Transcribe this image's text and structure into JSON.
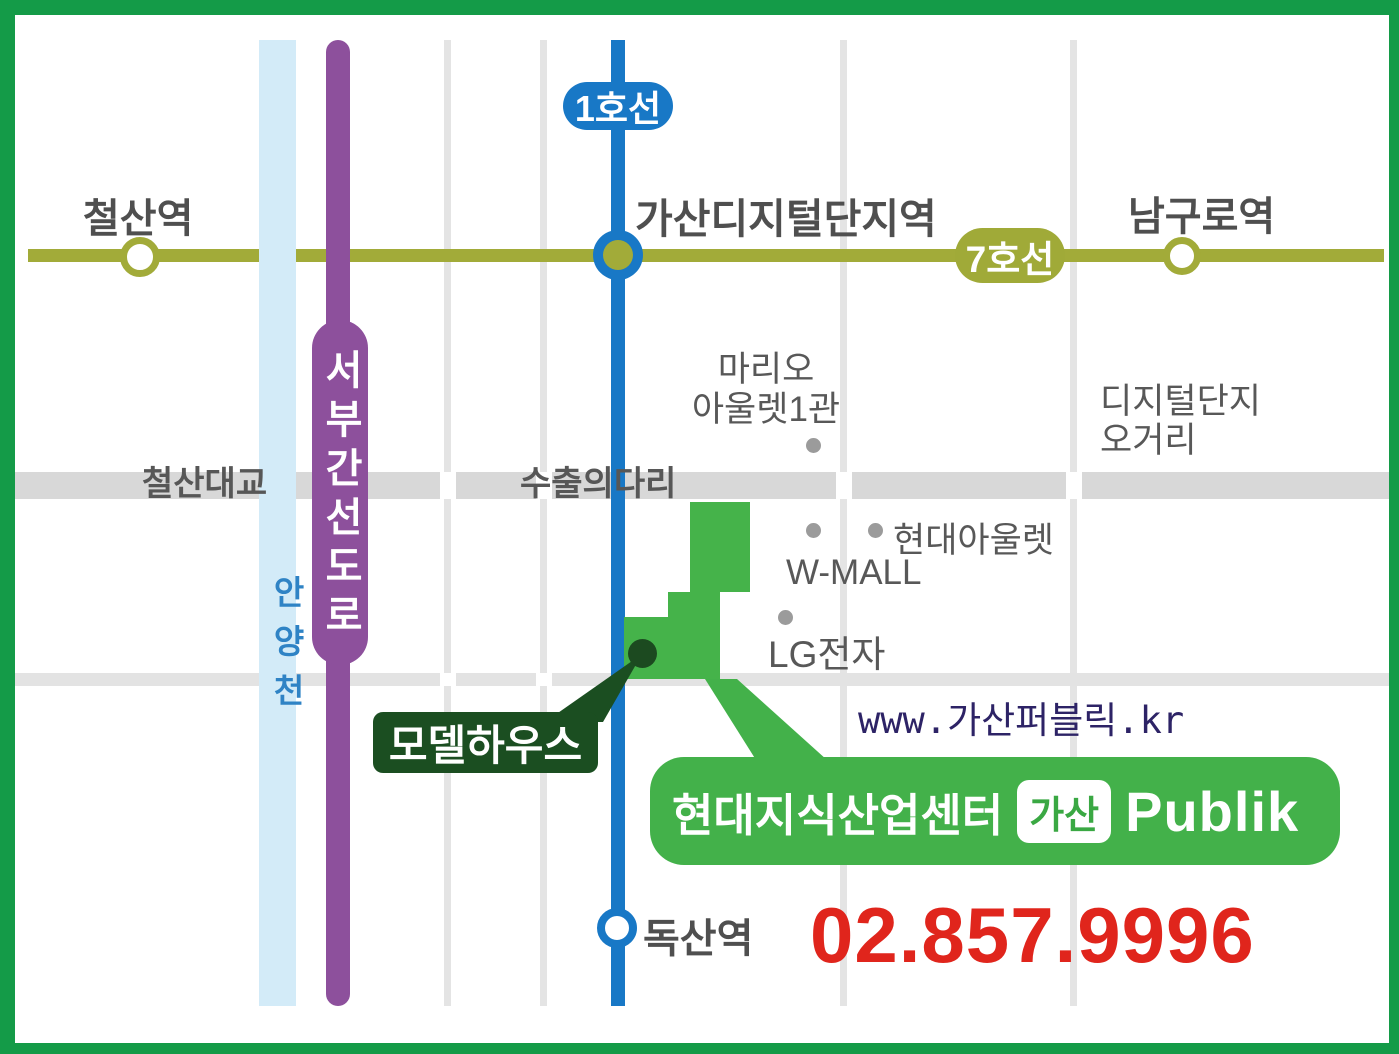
{
  "subway": {
    "line1_badge": "1호선",
    "line7_badge": "7호선",
    "stations": {
      "cheolsan": "철산역",
      "gasan_digital": "가산디지털단지역",
      "namguro": "남구로역",
      "doksan": "독산역"
    }
  },
  "roads": {
    "seobu_expressway": "서부간선도로",
    "cheolsan_bridge": "철산대교",
    "export_bridge": "수출의다리"
  },
  "river_name": "안양천",
  "landmarks": {
    "mario_outlet_line1": "마리오",
    "mario_outlet_line2": "아울렛1관",
    "hyundai_outlet": "현대아울렛",
    "w_mall": "W-MALL",
    "lg_electronics": "LG전자",
    "digital_complex_line1": "디지털단지",
    "digital_complex_line2": "오거리"
  },
  "callout": {
    "model_house": "모델하우스"
  },
  "banner": {
    "title": "현대지식산업센터",
    "badge": "가산",
    "brand": "Publik"
  },
  "contact": {
    "website": "www.가산퍼블릭.kr",
    "phone": "02.857.9996"
  },
  "colors": {
    "frame_green": "#149b48",
    "building_green": "#45b34a",
    "banner_green": "#43b14a",
    "callout_dark_green": "#1b4e21",
    "line1_blue": "#1878c6",
    "line7_olive": "#a2ab39",
    "road_purple": "#8d509c",
    "river_blue": "#d3ebf8",
    "road_gray": "#d8d8d8",
    "phone_red": "#e0251c",
    "website_navy": "#2d2366"
  }
}
